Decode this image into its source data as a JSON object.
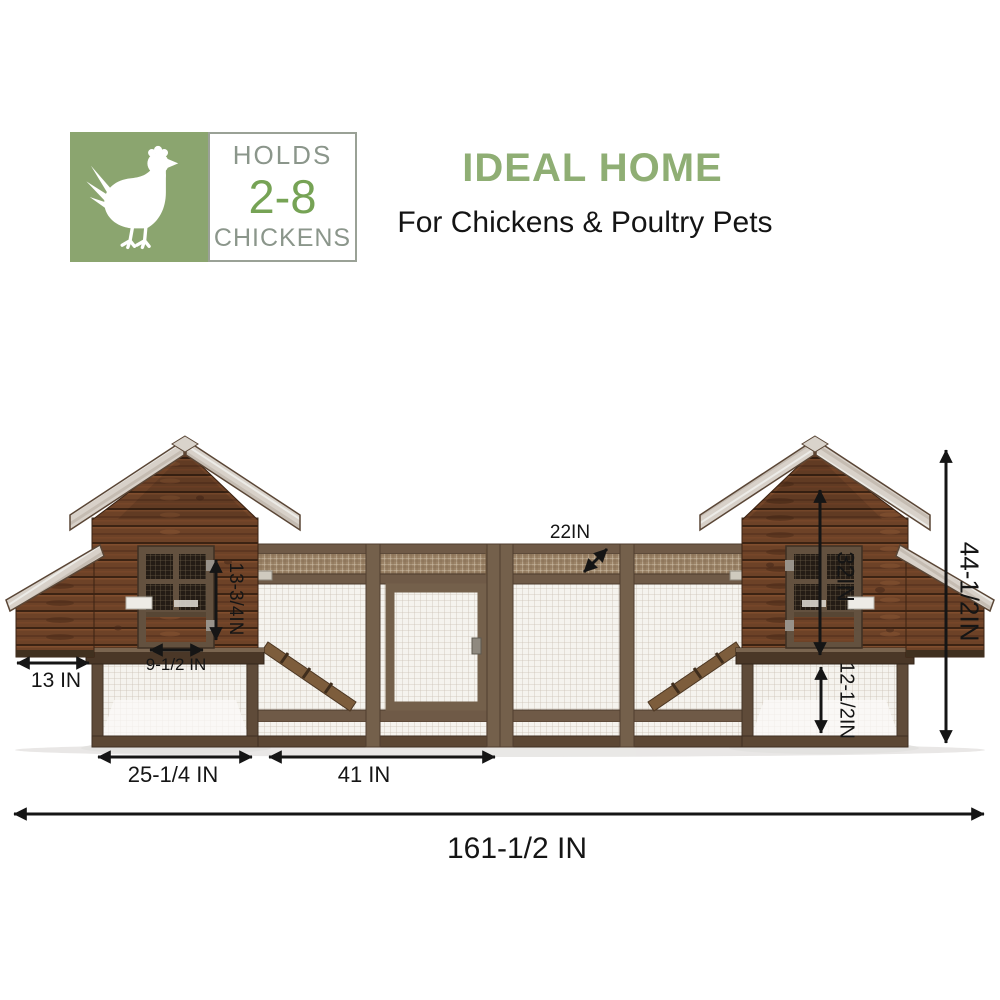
{
  "capacity_badge": {
    "holds": "HOLDS",
    "capacity": "2-8",
    "chickens": "CHICKENS",
    "icon": "chicken-silhouette",
    "panel_green": "#8ba56f",
    "text_gray": "#8b968b",
    "capacity_green": "#76a355"
  },
  "heading": {
    "title": "IDEAL HOME",
    "subtitle": "For Chickens & Poultry Pets",
    "title_green": "#8fae74"
  },
  "coop": {
    "alt": "Two-story wooden chicken coop with twin gabled hen houses, external nesting boxes and a central wire-mesh run",
    "wood_brown": "#6d4227",
    "frame_brown": "#6f5a47",
    "roof_gray": "#d8d1c9",
    "annotation_black": "#151515"
  },
  "dimensions": {
    "nest_box_width": "13 IN",
    "house_door_width": "9-1/2 IN",
    "house_door_height": "13-3/4IN",
    "run_depth": "22IN",
    "house_height": "32IN",
    "lower_run_height": "12-1/2IN",
    "overall_height": "44-1/2IN",
    "house_section_width": "25-1/4 IN",
    "run_section_width": "41 IN",
    "overall_length": "161-1/2 IN"
  }
}
